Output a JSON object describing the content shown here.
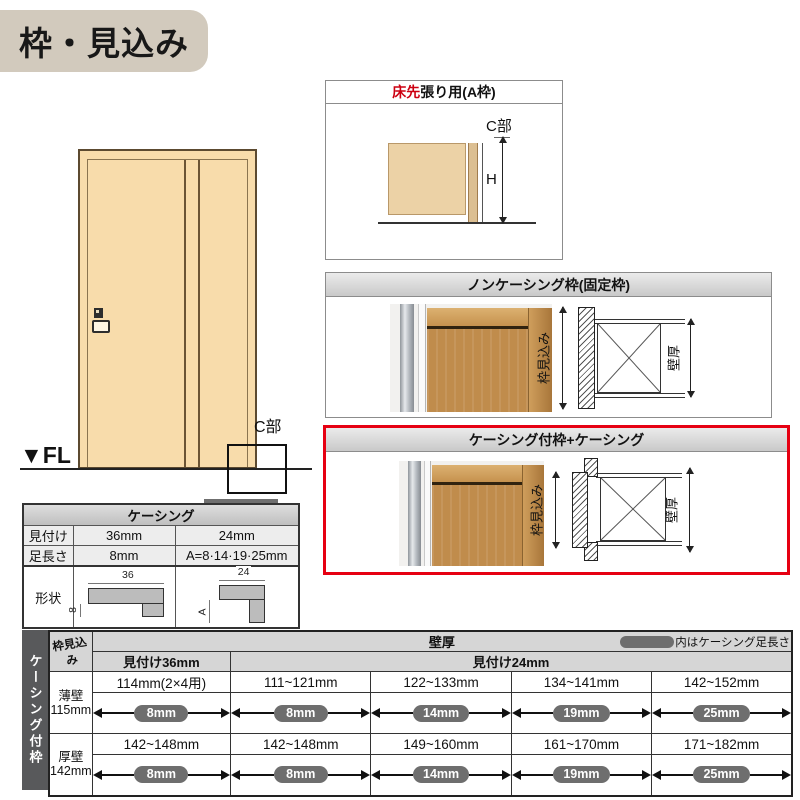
{
  "title": {
    "text": "枠・見込み"
  },
  "door_figure": {
    "fl_label": "▼FL",
    "c_part_label": "C部"
  },
  "frame_a_box": {
    "title_highlight": "床先",
    "title_rest": "張り用(A枠)",
    "c_part_label": "C部",
    "height_label": "H"
  },
  "noncasing_box": {
    "title": "ノンケーシング枠(固定枠)",
    "depth_label": "枠見込み",
    "wall_label": "壁厚"
  },
  "casing_box": {
    "title": "ケーシング付枠+ケーシング",
    "depth_label": "枠見込み",
    "wall_label": "壁厚"
  },
  "casing_spec_table": {
    "title": "ケーシング",
    "row_mitsuke": {
      "label": "見付け",
      "w36": "36mm",
      "w24": "24mm"
    },
    "row_ashinagasa": {
      "label": "足長さ",
      "w36": "8mm",
      "w24": "A=8·14·19·25mm"
    },
    "row_keijo": {
      "label": "形状"
    },
    "shape36": {
      "top_dim": "36",
      "leg_dim": "8"
    },
    "shape24": {
      "top_dim": "24",
      "leg_dim": "A"
    }
  },
  "matrix_table": {
    "side_label": "ケーシング付枠",
    "corner_header": "枠見込み",
    "wall_header": "壁厚",
    "legend_label": "内はケーシング足長さ",
    "group36_header": "見付け36mm",
    "group24_header": "見付け24mm",
    "rows": [
      {
        "wall_type": "薄壁",
        "depth": "115mm",
        "ranges": [
          "114mm(2×4用)",
          "111~121mm",
          "122~133mm",
          "134~141mm",
          "142~152mm"
        ],
        "legs": [
          "8mm",
          "8mm",
          "14mm",
          "19mm",
          "25mm"
        ]
      },
      {
        "wall_type": "厚壁",
        "depth": "142mm",
        "ranges": [
          "142~148mm",
          "142~148mm",
          "149~160mm",
          "161~170mm",
          "171~182mm"
        ],
        "legs": [
          "8mm",
          "8mm",
          "14mm",
          "19mm",
          "25mm"
        ]
      }
    ]
  },
  "colors": {
    "accent_red": "#e60012",
    "title_bg": "#d2cabd",
    "door_fill": "#f8dcab",
    "pill_gray": "#6e6e6e",
    "side_strip": "#58595b",
    "header_gray": "#d6d6d6",
    "wood": "#c08c4c"
  }
}
